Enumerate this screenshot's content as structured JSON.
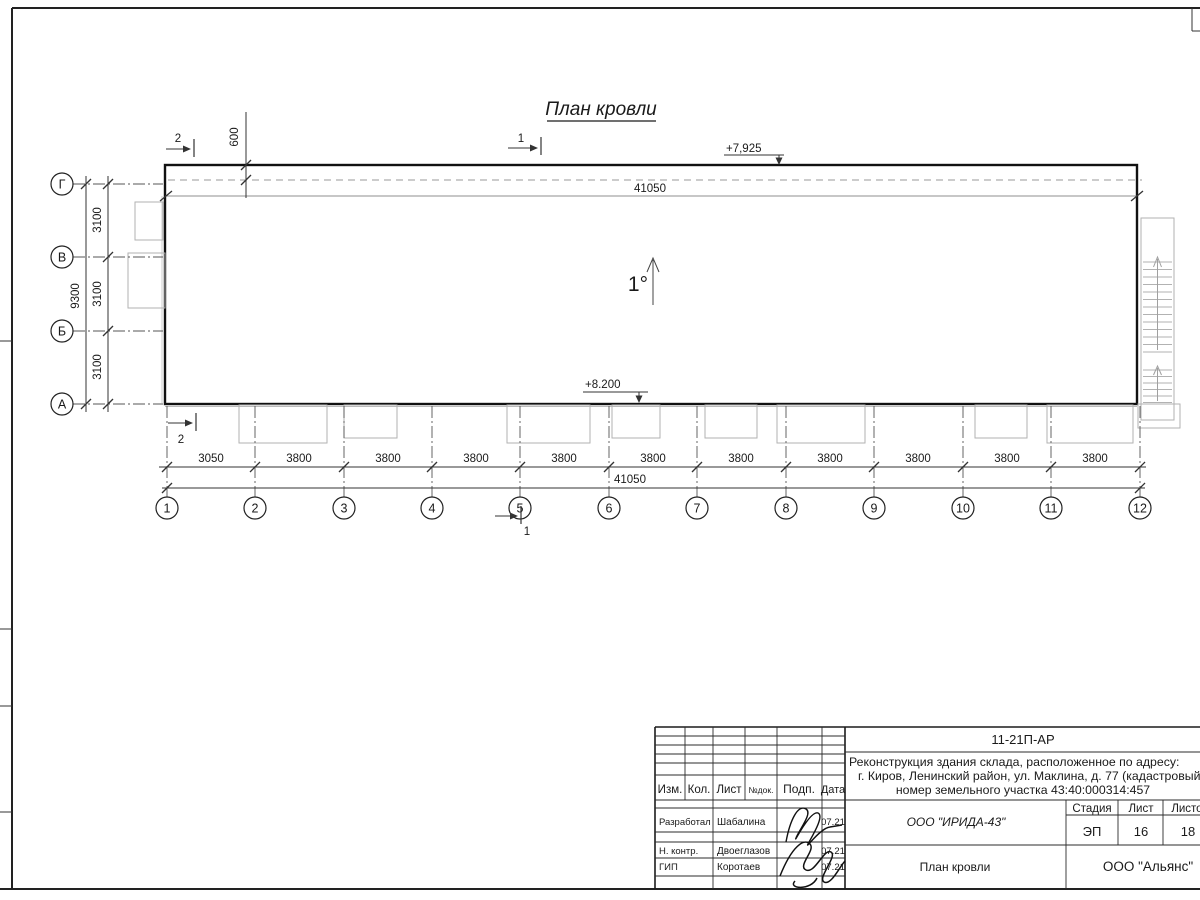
{
  "drawing": {
    "title": "План кровли",
    "slope_label": "1°",
    "elevation_top": "+7,925",
    "elevation_bottom": "+8.200",
    "dim_total_top": "41050",
    "dim_total_bottom": "41050",
    "dim_overhang": "600",
    "left_total": "9300",
    "left_segments": [
      "3100",
      "3100",
      "3100"
    ],
    "bottom_segments": [
      "3050",
      "3800",
      "3800",
      "3800",
      "3800",
      "3800",
      "3800",
      "3800",
      "3800",
      "3800",
      "3800"
    ],
    "axes_cols": [
      "1",
      "2",
      "3",
      "4",
      "5",
      "6",
      "7",
      "8",
      "9",
      "10",
      "11",
      "12"
    ],
    "axes_rows": [
      "Г",
      "В",
      "Б",
      "А"
    ],
    "sections": {
      "s1": "1",
      "s2": "2"
    }
  },
  "titleblock": {
    "doc_number": "11-21П-АР",
    "description_line1": "Реконструкция здания склада, расположенное по адресу:",
    "description_line2": "г. Киров, Ленинский район, ул. Маклина, д. 77 (кадастровый",
    "description_line3": "номер земельного участка 43:40:000314:457",
    "org": "ООО \"ИРИДА-43\"",
    "sheet_title": "План кровли",
    "company": "ООО \"Альянс\"",
    "stage_label": "Стадия",
    "sheet_label": "Лист",
    "sheets_label": "Листов",
    "stage_value": "ЭП",
    "sheet_value": "16",
    "sheets_value": "18",
    "header_cols": [
      "Изм.",
      "Кол.",
      "Лист",
      "№док.",
      "Подп.",
      "Дата"
    ],
    "rows": [
      {
        "role": "Разработал",
        "name": "Шабалина",
        "date": "07.21"
      },
      {
        "role": "Н. контр.",
        "name": "Двоеглазов",
        "date": "07.21"
      },
      {
        "role": "ГИП",
        "name": "Коротаев",
        "date": "07.21"
      }
    ]
  },
  "colors": {
    "line": "#1c1c1c",
    "light": "#b2b2b2",
    "mid": "#8f8f8f"
  }
}
